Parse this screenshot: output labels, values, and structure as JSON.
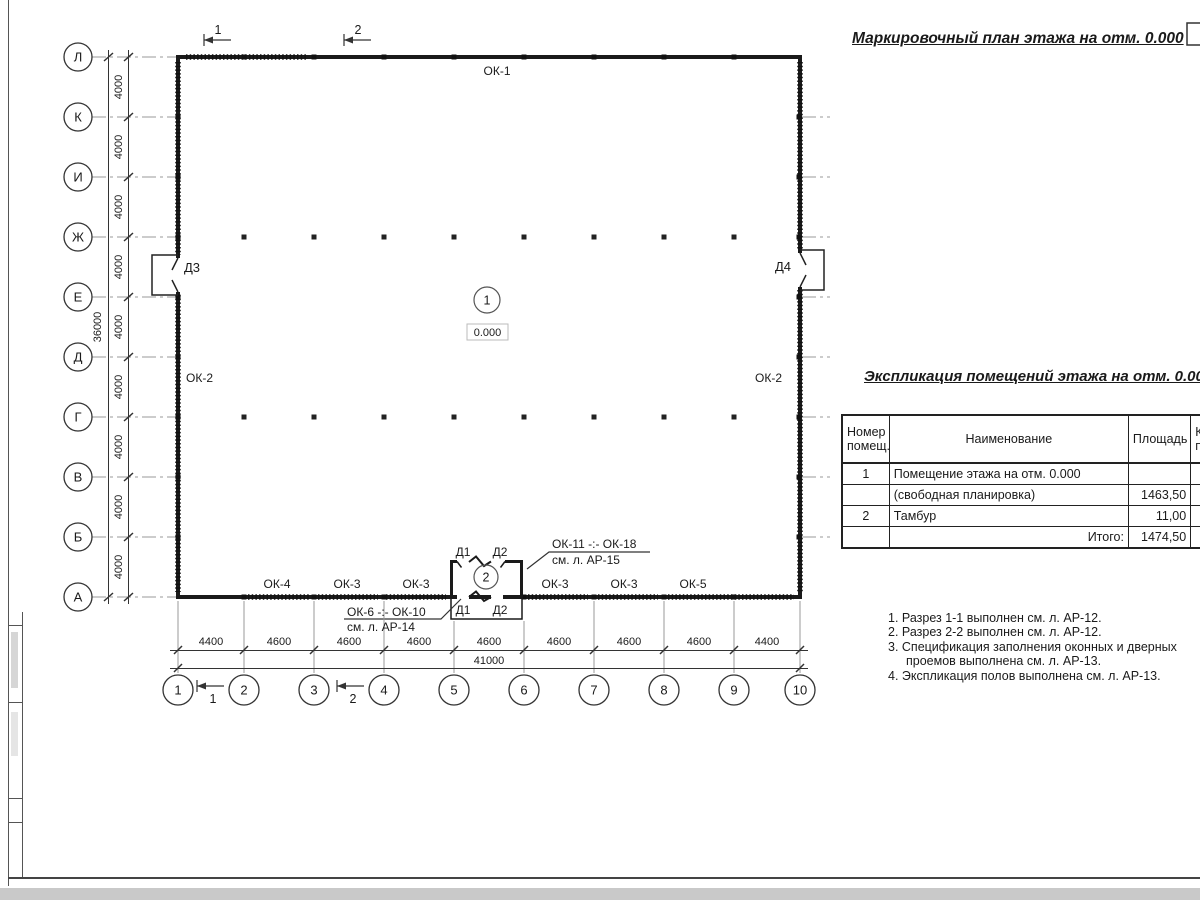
{
  "page": {
    "title": "Маркировочный план этажа на отм. 0.000"
  },
  "plan": {
    "row_axes": [
      "Л",
      "К",
      "И",
      "Ж",
      "Е",
      "Д",
      "Г",
      "В",
      "Б",
      "А"
    ],
    "col_axes": [
      "1",
      "2",
      "3",
      "4",
      "5",
      "6",
      "7",
      "8",
      "9",
      "10"
    ],
    "row_dim": "4000",
    "row_total": "36000",
    "col_dims": [
      "4400",
      "4600",
      "4600",
      "4600",
      "4600",
      "4600",
      "4600",
      "4600",
      "4400"
    ],
    "col_total": "41000",
    "labels": {
      "ok1": "ОК-1",
      "ok2_left": "ОК-2",
      "ok2_right": "ОК-2",
      "bottom_windows": [
        "ОК-4",
        "ОК-3",
        "ОК-3",
        "ОК-3",
        "ОК-3",
        "ОК-5"
      ],
      "d1": "Д1",
      "d2": "Д2",
      "d3": "Д3",
      "d4": "Д4"
    },
    "rooms": {
      "room1_num": "1",
      "room1_elev": "0.000",
      "room2_num": "2"
    },
    "sections": {
      "s1": "1",
      "s2": "2"
    },
    "leaders": {
      "top_line1": "ОК-11 -:- ОК-18",
      "top_line2": "см. л. АР-15",
      "bottom_line1": "ОК-6 -:- ОК-10",
      "bottom_line2": "см. л. АР-14"
    }
  },
  "table": {
    "title": "Экспликация помещений этажа на отм. 0.000",
    "headers": {
      "num_l1": "Номер",
      "num_l2": "помещ.",
      "name": "Наименование",
      "area": "Площадь",
      "cut_l1": "Ка",
      "cut_l2": "по"
    },
    "rows": [
      {
        "num": "1",
        "name": "Помещение этажа на отм. 0.000",
        "area": ""
      },
      {
        "num": "",
        "name": "(свободная планировка)",
        "area": "1463,50"
      },
      {
        "num": "2",
        "name": "Тамбур",
        "area": "11,00"
      },
      {
        "num": "",
        "name": "Итого:",
        "area": "1474,50"
      }
    ]
  },
  "notes": [
    "1. Разрез 1-1 выполнен см. л. АР-12.",
    "2. Разрез 2-2 выполнен см. л. АР-12.",
    "3. Спецификация заполнения оконных и дверных проемов выполнена см. л. АР-13.",
    "4. Экспликация полов выполнена см. л. АР-13."
  ],
  "colors": {
    "ink": "#1a1a1a",
    "grid": "#999999",
    "paper": "#ffffff"
  }
}
